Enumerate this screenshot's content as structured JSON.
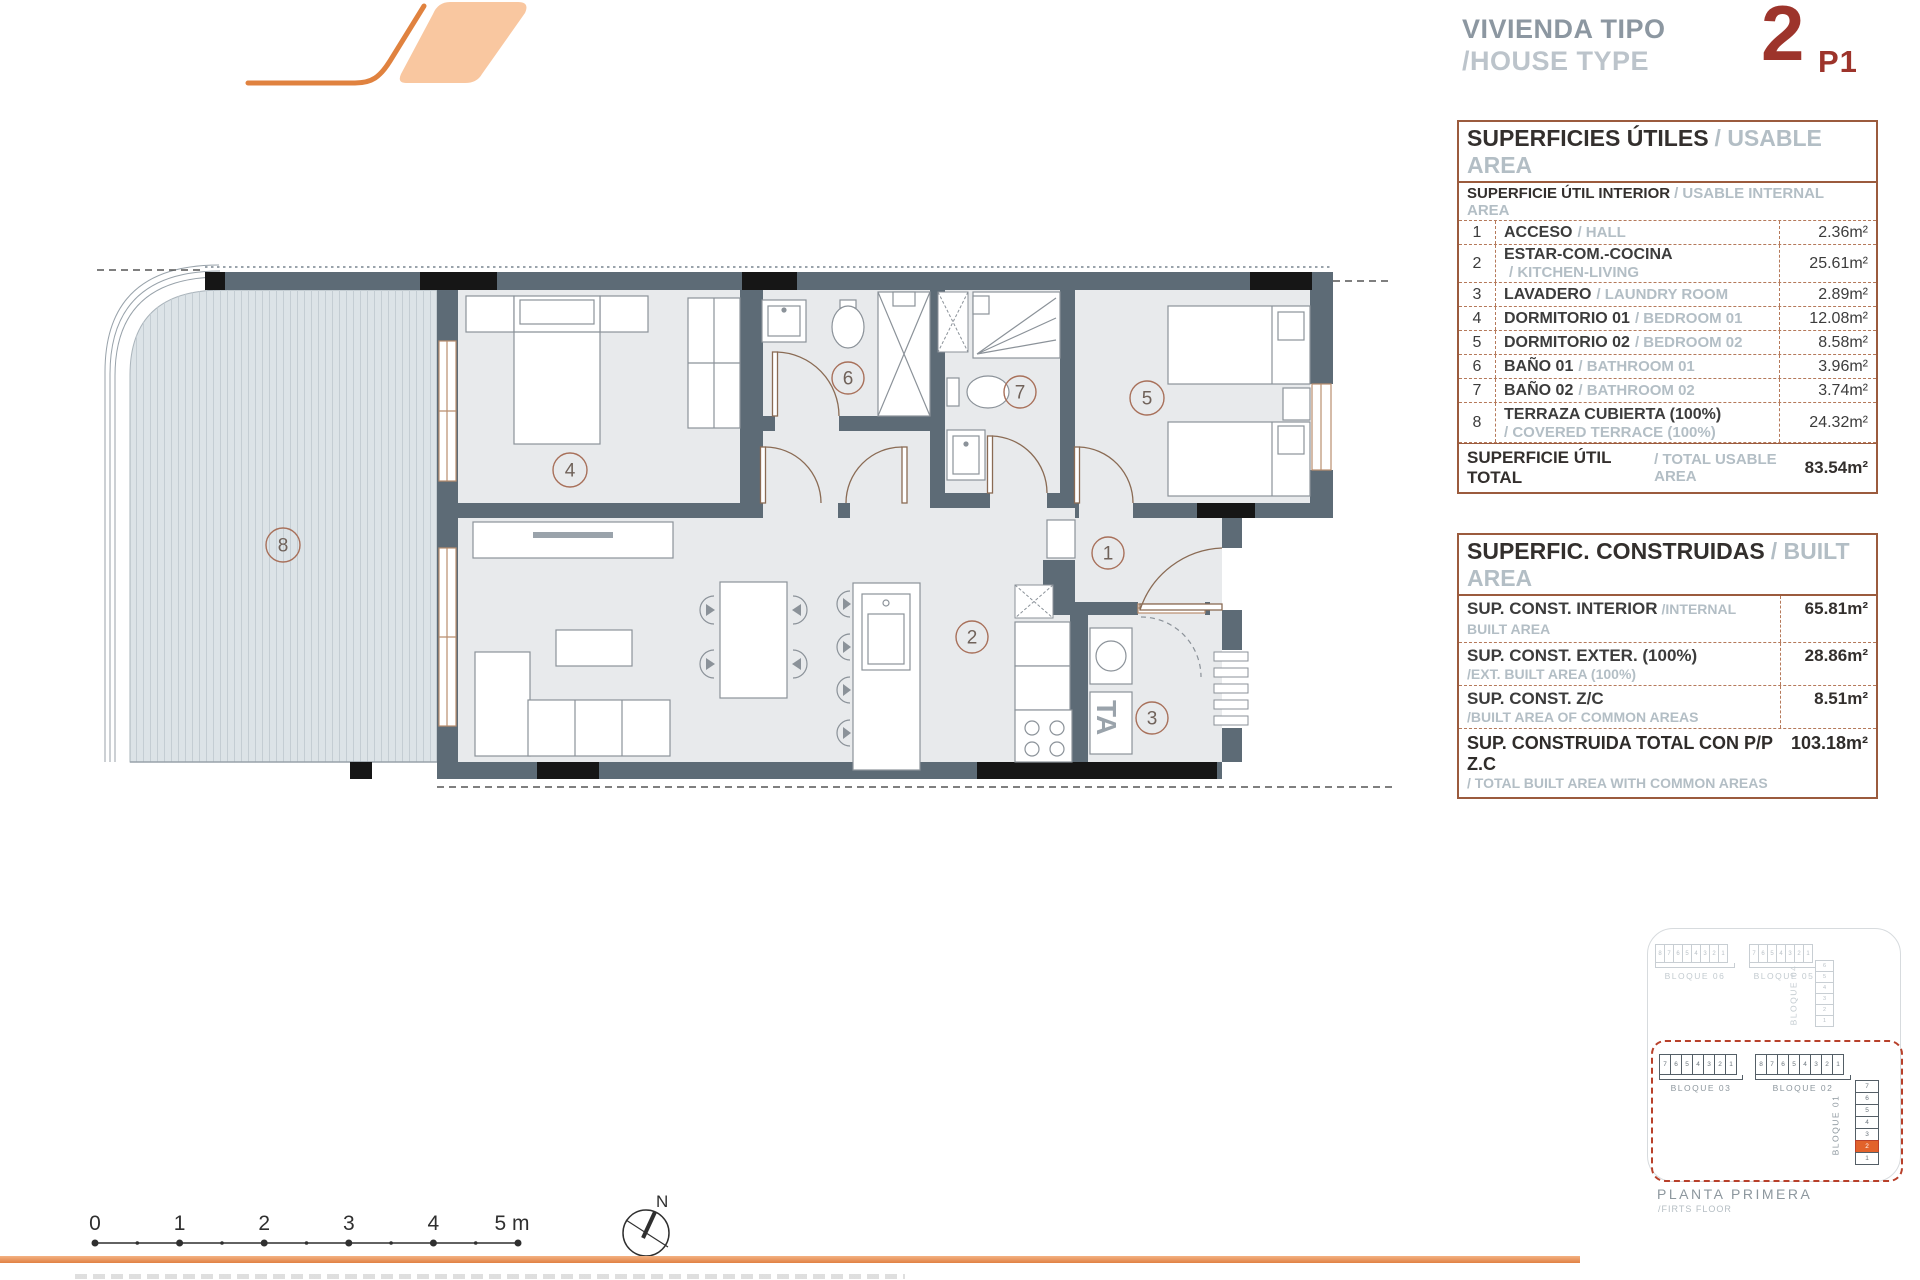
{
  "header": {
    "title_es": "VIVIENDA TIPO",
    "title_en": "/HOUSE TYPE",
    "type_number": "2",
    "floor_code": "P1"
  },
  "usable_table": {
    "title_es": "SUPERFICIES ÚTILES",
    "title_en": "/ USABLE AREA",
    "sub_es": "SUPERFICIE ÚTIL INTERIOR",
    "sub_en": "/ USABLE INTERNAL AREA",
    "rows": [
      {
        "num": "1",
        "es": "ACCESO",
        "en": "/ HALL",
        "value": "2.36m²"
      },
      {
        "num": "2",
        "es": "ESTAR-COM.-COCINA",
        "en": "/ KITCHEN-LIVING",
        "value": "25.61m²"
      },
      {
        "num": "3",
        "es": "LAVADERO",
        "en": "/ LAUNDRY ROOM",
        "value": "2.89m²"
      },
      {
        "num": "4",
        "es": "DORMITORIO 01",
        "en": "/ BEDROOM 01",
        "value": "12.08m²"
      },
      {
        "num": "5",
        "es": "DORMITORIO 02",
        "en": "/ BEDROOM 02",
        "value": "8.58m²"
      },
      {
        "num": "6",
        "es": "BAÑO 01",
        "en": "/ BATHROOM 01",
        "value": "3.96m²"
      },
      {
        "num": "7",
        "es": "BAÑO 02",
        "en": "/ BATHROOM 02",
        "value": "3.74m²"
      },
      {
        "num": "8",
        "es": "TERRAZA CUBIERTA (100%)",
        "en": "/ COVERED TERRACE (100%)",
        "value": "24.32m²",
        "stack": true
      }
    ],
    "total_es": "SUPERFICIE ÚTIL TOTAL",
    "total_en": "/ TOTAL USABLE AREA",
    "total_value": "83.54m²"
  },
  "built_table": {
    "title_es": "SUPERFIC. CONSTRUIDAS",
    "title_en": "/ BUILT AREA",
    "rows": [
      {
        "es": "SUP. CONST. INTERIOR",
        "en": "/INTERNAL BUILT AREA",
        "value": "65.81m²",
        "inline": true
      },
      {
        "es": "SUP. CONST. EXTER. (100%)",
        "en": "/EXT. BUILT AREA (100%)",
        "value": "28.86m²"
      },
      {
        "es": "SUP. CONST. Z/C",
        "en": "/BUILT AREA OF COMMON AREAS",
        "value": "8.51m²"
      }
    ],
    "total_es": "SUP. CONSTRUIDA TOTAL CON P/P Z.C",
    "total_en": "/ TOTAL BUILT AREA WITH COMMON AREAS",
    "total_value": "103.18m²"
  },
  "plan": {
    "labels": {
      "l1": "1",
      "l2": "2",
      "l3": "3",
      "l4": "4",
      "l5": "5",
      "l6": "6",
      "l7": "7",
      "l8": "8"
    },
    "ta_label": "TA"
  },
  "scale_bar": {
    "ticks": [
      "0",
      "1",
      "2",
      "3",
      "4",
      "5 m"
    ],
    "north": "N"
  },
  "site": {
    "bloque06": {
      "name": "BLOQUE 06",
      "units": [
        "8",
        "7",
        "6",
        "5",
        "4",
        "3",
        "2",
        "1"
      ]
    },
    "bloque05": {
      "name": "BLOQUE 05",
      "units": [
        "7",
        "6",
        "5",
        "4",
        "3",
        "2",
        "1"
      ]
    },
    "bloque04": {
      "name": "BLOQUE 04",
      "units": [
        "6",
        "5",
        "4",
        "3",
        "2",
        "1"
      ]
    },
    "bloque03": {
      "name": "BLOQUE 03",
      "units": [
        "7",
        "6",
        "5",
        "4",
        "3",
        "2",
        "1"
      ]
    },
    "bloque02": {
      "name": "BLOQUE 02",
      "units": [
        "8",
        "7",
        "6",
        "5",
        "4",
        "3",
        "2",
        "1"
      ]
    },
    "bloque01": {
      "name": "BLOQUE 01",
      "units": [
        {
          "n": "7"
        },
        {
          "n": "6"
        },
        {
          "n": "5"
        },
        {
          "n": "4"
        },
        {
          "n": "3"
        },
        {
          "n": "2",
          "highlight": true
        },
        {
          "n": "1"
        }
      ]
    },
    "floor_es": "PLANTA PRIMERA",
    "floor_en": "/FIRTS FLOOR"
  }
}
